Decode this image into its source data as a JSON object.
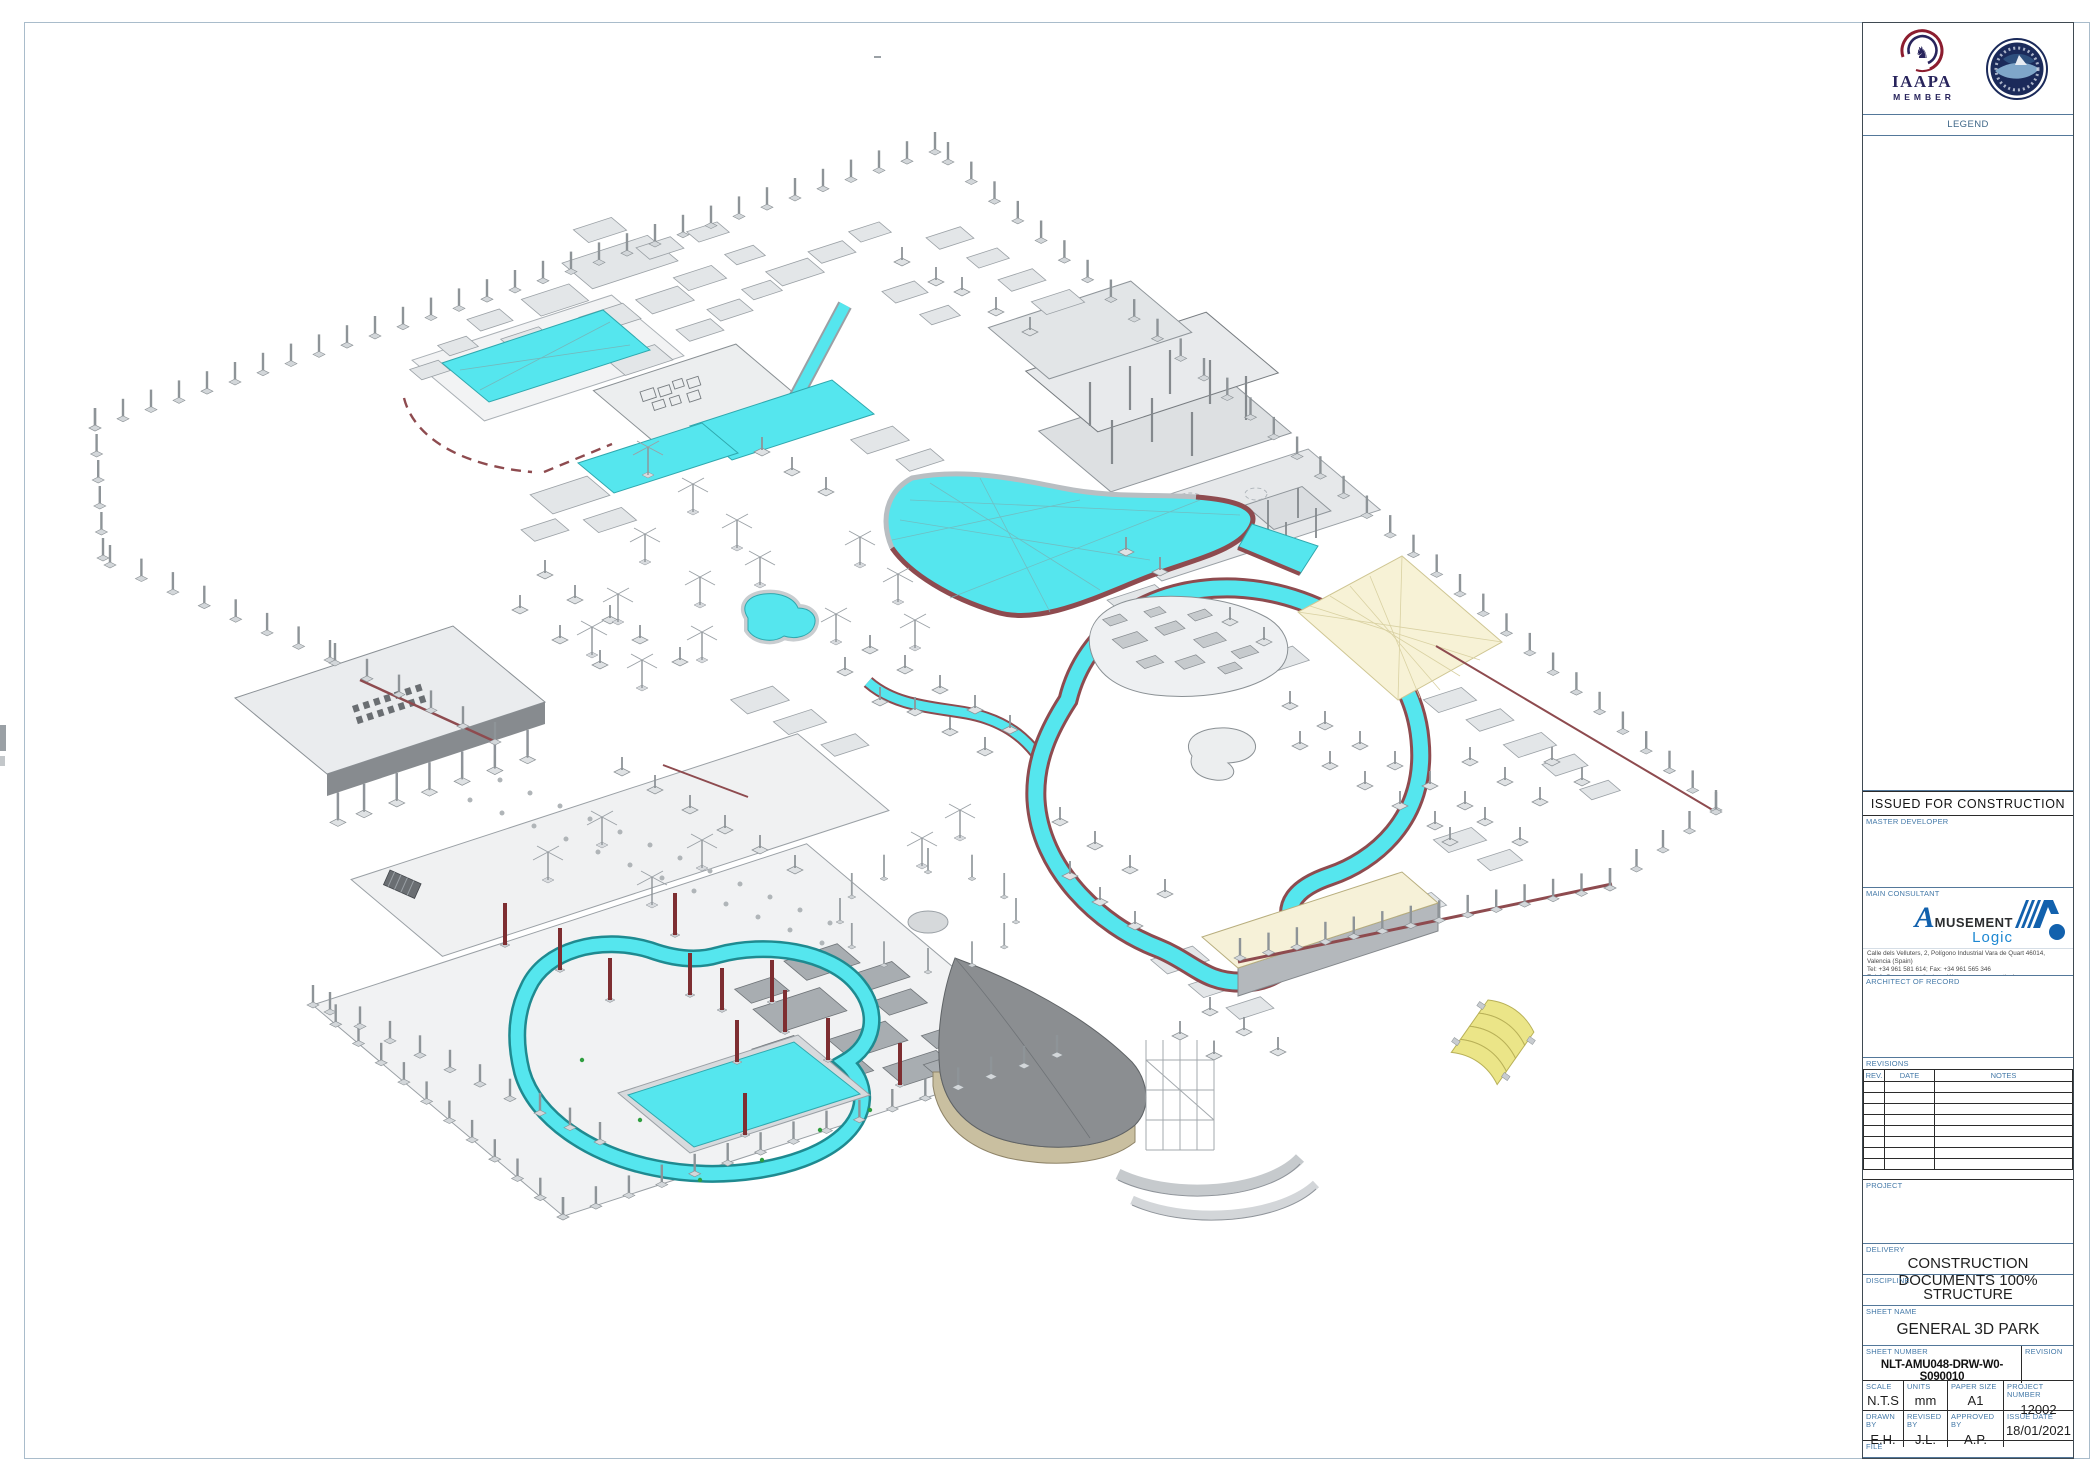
{
  "sheet": {
    "logos": {
      "iaapa_line1": "IAAPA",
      "iaapa_line2": "MEMBER",
      "horse_glyph": "♞",
      "park_logo_icon": "circular-waterpark-badge"
    },
    "legend": {
      "title": "LEGEND"
    },
    "issued_banner": "ISSUED FOR CONSTRUCTION",
    "stakeholders": {
      "master_developer_label": "MASTER DEVELOPER",
      "main_consultant_label": "MAIN CONSULTANT",
      "architect_label": "ARCHITECT OF RECORD"
    },
    "consultant": {
      "brand_a": "A",
      "brand_rest": "MUSEMENT",
      "brand_sub": "Logic",
      "address_line1": "Calle dels Velluters, 2, Polígono Industrial Vara de Quart 46014, Valencia (Spain)",
      "address_line2": "Tel: +34 961 581 614; Fax: +34 961 565 346",
      "address_line3": "E: info@amusementlogic.es W: www.amusementlogic.es"
    },
    "revisions": {
      "title": "REVISIONS",
      "headers": [
        "REV.",
        "DATE",
        "NOTES"
      ],
      "rows": [
        [
          "",
          "",
          ""
        ],
        [
          "",
          "",
          ""
        ],
        [
          "",
          "",
          ""
        ],
        [
          "",
          "",
          ""
        ],
        [
          "",
          "",
          ""
        ],
        [
          "",
          "",
          ""
        ],
        [
          "",
          "",
          ""
        ],
        [
          "",
          "",
          ""
        ]
      ]
    },
    "project_label": "PROJECT",
    "delivery": {
      "label": "DELIVERY",
      "value": "CONSTRUCTION DOCUMENTS 100%"
    },
    "discipline": {
      "label": "DISCIPLINE",
      "value": "STRUCTURE"
    },
    "sheet_name": {
      "label": "SHEET NAME",
      "value": "GENERAL 3D PARK"
    },
    "sheet_number": {
      "label": "SHEET NUMBER",
      "value": "NLT-AMU048-DRW-W0- S090010"
    },
    "revision": {
      "label": "REVISION",
      "value": ""
    },
    "scale": {
      "label": "SCALE",
      "value": "N.T.S"
    },
    "units": {
      "label": "UNITS",
      "value": "mm"
    },
    "paper_size": {
      "label": "PAPER SIZE",
      "value": "A1"
    },
    "project_number": {
      "label": "PROJECT NUMBER",
      "value": "12002"
    },
    "drawn_by": {
      "label": "DRAWN BY",
      "value": "E.H."
    },
    "revised_by": {
      "label": "REVISED BY",
      "value": "J.L."
    },
    "approved_by": {
      "label": "APPROVED BY",
      "value": "A.P."
    },
    "issue_date": {
      "label": "ISSUE DATE",
      "value": "18/01/2021"
    },
    "file": {
      "label": "FILE",
      "value": ""
    }
  },
  "drawing_features": [
    "wave-pool",
    "lazy-river-loop",
    "kids-river-loop",
    "rect-pool",
    "slide-channel",
    "perimeter-column-fence",
    "boat-pavilion",
    "shade-sail",
    "caterpillar-canopy",
    "splash-pad-island"
  ],
  "colors": {
    "pool_cyan": "#55E6EE",
    "pool_edge_teal": "#2FA8AE",
    "wall_maroon": "#8E4B4F",
    "structure_gray": "#D9DCDE",
    "canopy_cream": "#F6F1D8",
    "canopy_yellow": "#EBE588",
    "label_blue": "#4479A8",
    "brand_blue": "#1261AD",
    "iaapa_navy": "#28245C",
    "iaapa_red": "#8C1D2F"
  }
}
